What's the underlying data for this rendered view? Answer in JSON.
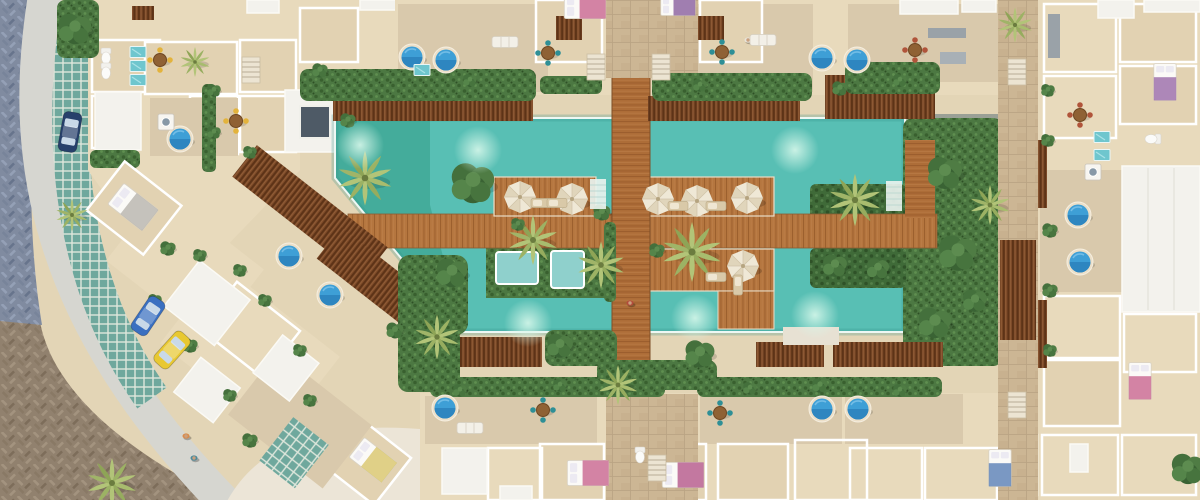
{
  "scene": {
    "alt": "Aerial top-down 3D render of a tropical resort condominium complex with long turquoise pools, wooden boardwalk bridge, umbrella sun decks, palm trees, cutaway apartment interiors with plunge pools, and a curved cobblestone street with parked cars at the lower left",
    "colors": {
      "base": "#e3d5b6",
      "building_cream": "#e8dabc",
      "room_floor": "#e2d2b2",
      "terrace_stone": "#d9c9ac",
      "roof_white": "#f3f2ed",
      "wall_white": "#ffffff",
      "pool": "#58bfb4",
      "pool_deep": "#2f8f89",
      "pool_arm_green": "#2f9a82",
      "inner_pool": "#8fd0cc",
      "coping": "#eef8f4",
      "deck_wood": "#b5763f",
      "plank_line": "#9a5d2c",
      "pergola_wood": "#7c4a28",
      "bridge_wood": "#ad6d38",
      "hedge": "#4c7842",
      "hedge_dark": "#3f6a38",
      "palm": "#b2c478",
      "tree": "#44703c",
      "umbrella": "#efe8d6",
      "umbrella_rib": "#cfc2a6",
      "street_brown": "#91816e",
      "street_blue": "#808ba0",
      "sidewalk": "#d6d6d0",
      "sand": "#ece5d7",
      "patio_tile": "#6fa89d",
      "plunge_water": "#3e9fd6",
      "glow": "#d6f7ea",
      "car_navy": "#27406b",
      "car_blue": "#3a6fc0",
      "car_yellow": "#e8c832",
      "stone_path": "#ccb694",
      "gray_stone": "#9aa096",
      "skylight": "#4e5a66",
      "appliance": "#8798a6"
    },
    "sprites": [
      {
        "s": "palm",
        "x": 365,
        "y": 178,
        "k": 1.1
      },
      {
        "s": "palm",
        "x": 533,
        "y": 240,
        "k": 1.0
      },
      {
        "s": "palm",
        "x": 601,
        "y": 265,
        "k": 0.95
      },
      {
        "s": "palm",
        "x": 692,
        "y": 252,
        "k": 1.2
      },
      {
        "s": "palm",
        "x": 855,
        "y": 200,
        "k": 1.05
      },
      {
        "s": "palm",
        "x": 990,
        "y": 205,
        "k": 0.8
      },
      {
        "s": "palm",
        "x": 437,
        "y": 337,
        "k": 0.9
      },
      {
        "s": "palm",
        "x": 618,
        "y": 385,
        "k": 0.8
      },
      {
        "s": "palm",
        "x": 112,
        "y": 483,
        "k": 1.0
      },
      {
        "s": "palm",
        "x": 195,
        "y": 62,
        "k": 0.6
      },
      {
        "s": "palm",
        "x": 72,
        "y": 215,
        "k": 0.65
      },
      {
        "s": "palm",
        "x": 1015,
        "y": 25,
        "k": 0.7
      },
      {
        "s": "tree",
        "x": 473,
        "y": 182,
        "k": 1.25
      },
      {
        "s": "tree",
        "x": 452,
        "y": 272,
        "k": 0.9
      },
      {
        "s": "tree",
        "x": 560,
        "y": 345,
        "k": 0.75
      },
      {
        "s": "tree",
        "x": 945,
        "y": 172,
        "k": 1.0
      },
      {
        "s": "tree",
        "x": 958,
        "y": 252,
        "k": 1.1
      },
      {
        "s": "tree",
        "x": 935,
        "y": 322,
        "k": 0.95
      },
      {
        "s": "tree",
        "x": 75,
        "y": 28,
        "k": 0.95
      },
      {
        "s": "tree",
        "x": 1188,
        "y": 468,
        "k": 0.95
      },
      {
        "s": "tree",
        "x": 700,
        "y": 353,
        "k": 0.85
      },
      {
        "s": "tree",
        "x": 835,
        "y": 265,
        "k": 0.7
      },
      {
        "s": "tree",
        "x": 878,
        "y": 268,
        "k": 0.65
      },
      {
        "s": "tree",
        "x": 975,
        "y": 300,
        "k": 0.7
      },
      {
        "s": "tree",
        "x": 602,
        "y": 212,
        "k": 0.5
      },
      {
        "s": "tree",
        "x": 657,
        "y": 250,
        "k": 0.45
      },
      {
        "s": "tree",
        "x": 518,
        "y": 224,
        "k": 0.4
      },
      {
        "s": "tree",
        "x": 470,
        "y": 80,
        "k": 0.4
      },
      {
        "s": "tree",
        "x": 700,
        "y": 85,
        "k": 0.4
      },
      {
        "s": "tree",
        "x": 840,
        "y": 88,
        "k": 0.45
      },
      {
        "s": "tree",
        "x": 900,
        "y": 80,
        "k": 0.4
      },
      {
        "s": "tree",
        "x": 460,
        "y": 390,
        "k": 0.4
      },
      {
        "s": "tree",
        "x": 560,
        "y": 385,
        "k": 0.4
      },
      {
        "s": "tree",
        "x": 750,
        "y": 388,
        "k": 0.4
      },
      {
        "s": "tree",
        "x": 820,
        "y": 385,
        "k": 0.45
      },
      {
        "s": "tree",
        "x": 900,
        "y": 390,
        "k": 0.4
      },
      {
        "s": "tree",
        "x": 1048,
        "y": 90,
        "k": 0.4
      },
      {
        "s": "tree",
        "x": 1048,
        "y": 140,
        "k": 0.4
      },
      {
        "s": "tree",
        "x": 1050,
        "y": 230,
        "k": 0.45
      },
      {
        "s": "tree",
        "x": 1050,
        "y": 290,
        "k": 0.45
      },
      {
        "s": "tree",
        "x": 1050,
        "y": 350,
        "k": 0.4
      },
      {
        "s": "tree",
        "x": 214,
        "y": 90,
        "k": 0.4
      },
      {
        "s": "tree",
        "x": 214,
        "y": 132,
        "k": 0.4
      },
      {
        "s": "tree",
        "x": 250,
        "y": 152,
        "k": 0.4
      },
      {
        "s": "tree",
        "x": 320,
        "y": 70,
        "k": 0.45
      },
      {
        "s": "tree",
        "x": 168,
        "y": 248,
        "k": 0.45
      },
      {
        "s": "tree",
        "x": 200,
        "y": 255,
        "k": 0.4
      },
      {
        "s": "tree",
        "x": 240,
        "y": 270,
        "k": 0.4
      },
      {
        "s": "tree",
        "x": 155,
        "y": 300,
        "k": 0.4
      },
      {
        "s": "tree",
        "x": 190,
        "y": 345,
        "k": 0.45
      },
      {
        "s": "tree",
        "x": 230,
        "y": 395,
        "k": 0.4
      },
      {
        "s": "tree",
        "x": 265,
        "y": 300,
        "k": 0.4
      },
      {
        "s": "tree",
        "x": 300,
        "y": 350,
        "k": 0.4
      },
      {
        "s": "tree",
        "x": 250,
        "y": 440,
        "k": 0.45
      },
      {
        "s": "tree",
        "x": 310,
        "y": 400,
        "k": 0.4
      },
      {
        "s": "tree",
        "x": 348,
        "y": 120,
        "k": 0.45
      },
      {
        "s": "tree",
        "x": 395,
        "y": 330,
        "k": 0.5
      },
      {
        "s": "umbrella",
        "x": 520,
        "y": 197
      },
      {
        "s": "umbrella",
        "x": 572,
        "y": 199
      },
      {
        "s": "umbrella",
        "x": 658,
        "y": 199
      },
      {
        "s": "umbrella",
        "x": 697,
        "y": 201
      },
      {
        "s": "umbrella",
        "x": 747,
        "y": 198
      },
      {
        "s": "umbrella",
        "x": 743,
        "y": 266
      },
      {
        "s": "plunge",
        "x": 412,
        "y": 57
      },
      {
        "s": "plunge",
        "x": 446,
        "y": 60
      },
      {
        "s": "plunge",
        "x": 822,
        "y": 58
      },
      {
        "s": "plunge",
        "x": 857,
        "y": 60
      },
      {
        "s": "plunge",
        "x": 180,
        "y": 139
      },
      {
        "s": "plunge",
        "x": 1078,
        "y": 215
      },
      {
        "s": "plunge",
        "x": 1080,
        "y": 262
      },
      {
        "s": "plunge",
        "x": 289,
        "y": 256
      },
      {
        "s": "plunge",
        "x": 330,
        "y": 295
      },
      {
        "s": "plunge",
        "x": 445,
        "y": 408
      },
      {
        "s": "plunge",
        "x": 822,
        "y": 409
      },
      {
        "s": "plunge",
        "x": 858,
        "y": 409
      },
      {
        "s": "car",
        "x": 70,
        "y": 132,
        "r": 10,
        "c": "#27406b"
      },
      {
        "s": "car",
        "x": 148,
        "y": 316,
        "r": 34,
        "c": "#3a6fc0"
      },
      {
        "s": "car",
        "x": 172,
        "y": 350,
        "r": 42,
        "c": "#e8c832"
      },
      {
        "s": "glow",
        "x": 478,
        "y": 150
      },
      {
        "s": "glow",
        "x": 795,
        "y": 150
      },
      {
        "s": "glow",
        "x": 360,
        "y": 145
      },
      {
        "s": "glow",
        "x": 528,
        "y": 323
      },
      {
        "s": "glow",
        "x": 815,
        "y": 315
      },
      {
        "s": "glow",
        "x": 695,
        "y": 318
      },
      {
        "s": "person",
        "x": 630,
        "y": 303,
        "c": "#b34a3c"
      },
      {
        "s": "person",
        "x": 186,
        "y": 436,
        "c": "#d98a4a"
      },
      {
        "s": "person",
        "x": 194,
        "y": 458,
        "c": "#4a8a9c"
      },
      {
        "s": "person",
        "x": 748,
        "y": 40,
        "c": "#e8e4da"
      },
      {
        "s": "lounger",
        "x": 541,
        "y": 203
      },
      {
        "s": "lounger",
        "x": 557,
        "y": 203
      },
      {
        "s": "lounger",
        "x": 678,
        "y": 206
      },
      {
        "s": "lounger",
        "x": 716,
        "y": 206
      },
      {
        "s": "lounger",
        "x": 716,
        "y": 277
      },
      {
        "s": "lounger",
        "x": 738,
        "y": 285,
        "r": 90
      },
      {
        "s": "sofa",
        "x": 505,
        "y": 42
      },
      {
        "s": "sofa",
        "x": 763,
        "y": 40
      },
      {
        "s": "sofa",
        "x": 470,
        "y": 428
      },
      {
        "s": "table",
        "x": 548,
        "y": 53
      },
      {
        "s": "table",
        "x": 722,
        "y": 52
      },
      {
        "s": "table",
        "x": 236,
        "y": 121,
        "c": "#e3b33c"
      },
      {
        "s": "table",
        "x": 160,
        "y": 60,
        "c": "#e3b33c"
      },
      {
        "s": "table",
        "x": 543,
        "y": 410
      },
      {
        "s": "table",
        "x": 720,
        "y": 413
      },
      {
        "s": "table",
        "x": 1080,
        "y": 115,
        "c": "#b0543a"
      },
      {
        "s": "table",
        "x": 915,
        "y": 50,
        "c": "#b0543a"
      },
      {
        "s": "bed",
        "x": 585,
        "y": 6,
        "k": 0.9,
        "c": "#c9658f"
      },
      {
        "s": "bed",
        "x": 678,
        "y": 5,
        "k": 0.75,
        "c": "#8a5f9e"
      },
      {
        "s": "bed",
        "x": 1165,
        "y": 82,
        "r": 90,
        "k": 0.8,
        "c": "#9a6aa8"
      },
      {
        "s": "bed",
        "x": 1140,
        "y": 381,
        "r": 90,
        "k": 0.8,
        "c": "#c9658f"
      },
      {
        "s": "bed",
        "x": 1000,
        "y": 468,
        "r": 90,
        "k": 0.8,
        "c": "#5a7fb5"
      },
      {
        "s": "bed",
        "x": 588,
        "y": 473,
        "k": 0.9,
        "c": "#c9658f"
      },
      {
        "s": "bed",
        "x": 683,
        "y": 475,
        "k": 0.9,
        "c": "#b5588a"
      },
      {
        "s": "bed",
        "x": 133,
        "y": 207,
        "r": 38,
        "k": 0.95,
        "c": "#b8b4ac"
      },
      {
        "s": "bed",
        "x": 373,
        "y": 460,
        "r": 38,
        "k": 0.9,
        "c": "#d9c66a"
      },
      {
        "s": "stairs",
        "x": 596,
        "y": 67
      },
      {
        "s": "stairs",
        "x": 661,
        "y": 67
      },
      {
        "s": "stairs",
        "x": 251,
        "y": 70
      },
      {
        "s": "stairs",
        "x": 1017,
        "y": 405
      },
      {
        "s": "stairs",
        "x": 1017,
        "y": 72
      },
      {
        "s": "stairs",
        "x": 657,
        "y": 468
      },
      {
        "s": "washer",
        "x": 166,
        "y": 122
      },
      {
        "s": "washer",
        "x": 1093,
        "y": 172
      },
      {
        "s": "toilet",
        "x": 106,
        "y": 56
      },
      {
        "s": "toilet",
        "x": 106,
        "y": 71
      },
      {
        "s": "toilet",
        "x": 1153,
        "y": 139,
        "r": 90
      },
      {
        "s": "toilet",
        "x": 640,
        "y": 455
      },
      {
        "s": "tealpanel",
        "x": 138,
        "y": 52
      },
      {
        "s": "tealpanel",
        "x": 138,
        "y": 66
      },
      {
        "s": "tealpanel",
        "x": 138,
        "y": 80
      },
      {
        "s": "tealpanel",
        "x": 422,
        "y": 70
      },
      {
        "s": "tealpanel",
        "x": 1102,
        "y": 137
      },
      {
        "s": "tealpanel",
        "x": 1102,
        "y": 155
      },
      {
        "s": "steps",
        "x": 598,
        "y": 194
      },
      {
        "s": "steps",
        "x": 894,
        "y": 196
      }
    ]
  }
}
